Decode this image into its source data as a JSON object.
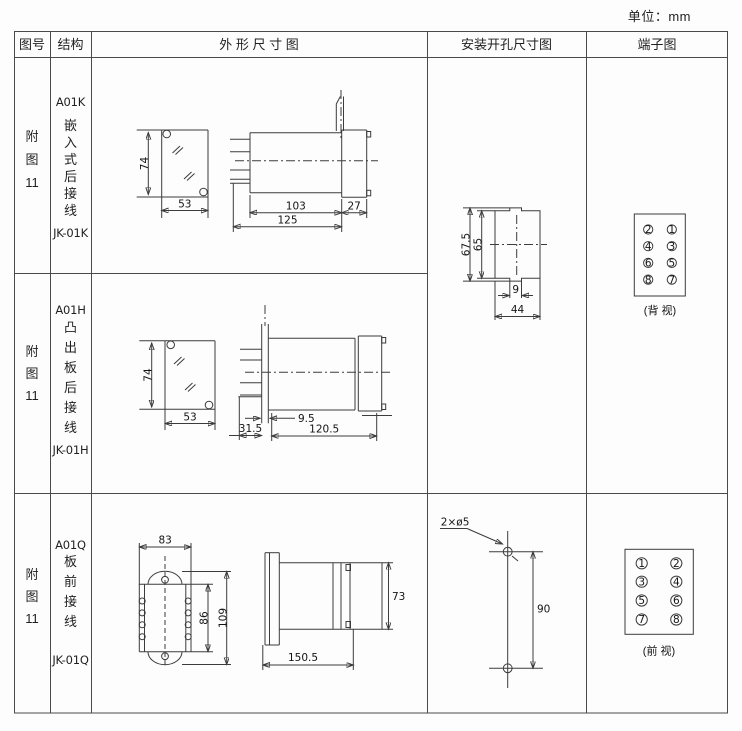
{
  "unit_label": "单位：mm",
  "headers": [
    "图号",
    "结构",
    "外 形 尺 寸 图",
    "安装开孔尺寸图",
    "端子图"
  ],
  "rows": [
    {
      "fig": [
        "附",
        "图",
        "11"
      ],
      "model": "A01K",
      "desc": [
        "嵌",
        "入",
        "式",
        "后",
        "接",
        "线"
      ],
      "code": "JK-01K"
    },
    {
      "fig": [
        "附",
        "图",
        "11"
      ],
      "model": "A01H",
      "desc": [
        "凸",
        "出",
        "板",
        "后",
        "接",
        "线"
      ],
      "code": "JK-01H"
    },
    {
      "fig": [
        "附",
        "图",
        "11"
      ],
      "model": "A01Q",
      "desc": [
        "板",
        "前",
        "接",
        "线"
      ],
      "code": "JK-01Q"
    }
  ],
  "dims": {
    "r1": {
      "front_h": "74",
      "front_w": "53",
      "body_len": "103",
      "flange": "27",
      "total_len": "125"
    },
    "r2": {
      "front_h": "74",
      "front_w": "53",
      "pin_offset": "9.5",
      "front_depth": "31.5",
      "body_len": "120.5"
    },
    "r3": {
      "front_w": "83",
      "inner_h": "86",
      "total_h": "109",
      "side_h": "73",
      "side_len": "150.5"
    },
    "install12": {
      "outer_h": "67.5",
      "inner_h": "65",
      "notch_w": "9",
      "cutout_w": "44"
    },
    "install3": {
      "hole_label": "2×ø5",
      "hole_spacing": "90"
    }
  },
  "terminals": {
    "back": {
      "label": "(背 视)",
      "rows": [
        [
          "2",
          "1"
        ],
        [
          "4",
          "3"
        ],
        [
          "6",
          "5"
        ],
        [
          "8",
          "7"
        ]
      ]
    },
    "front": {
      "label": "(前 视)",
      "rows": [
        [
          "1",
          "2"
        ],
        [
          "3",
          "4"
        ],
        [
          "5",
          "6"
        ],
        [
          "7",
          "8"
        ]
      ]
    }
  }
}
